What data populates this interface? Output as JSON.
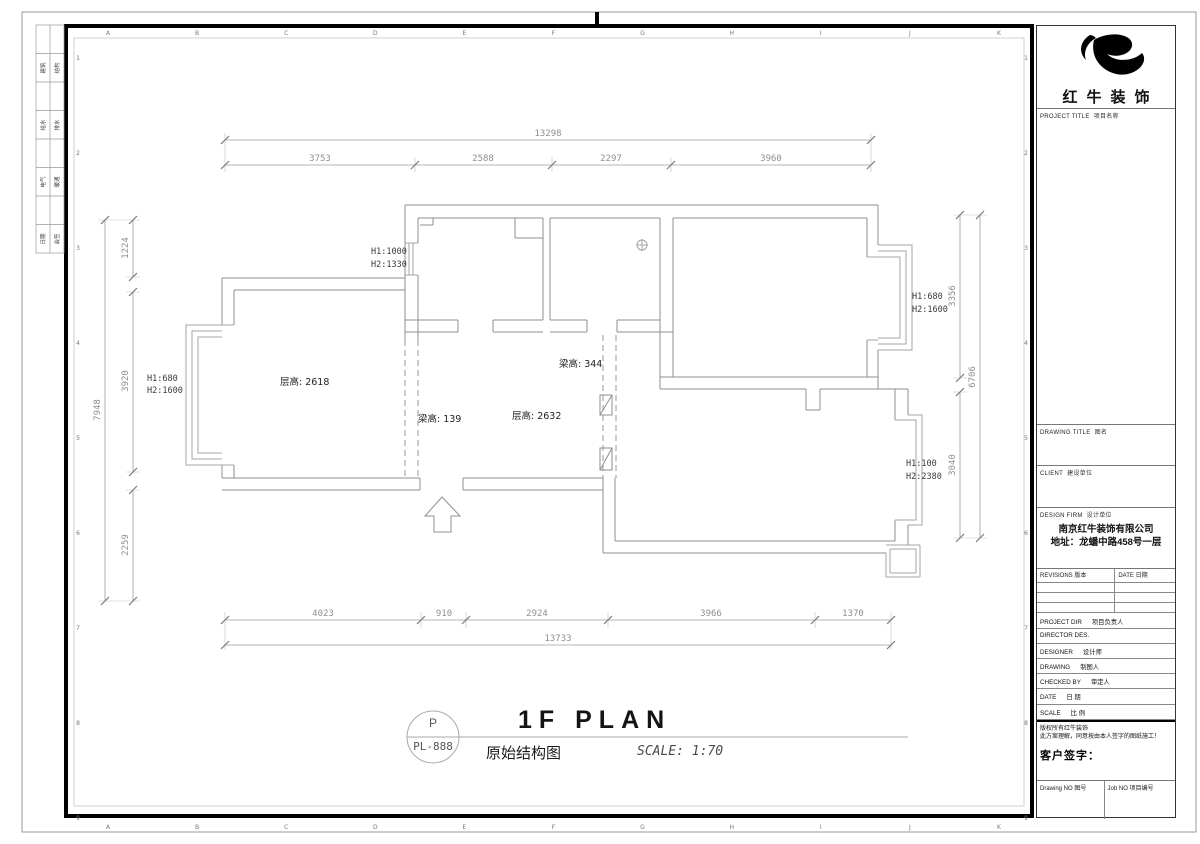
{
  "frame": {
    "top_letters": [
      "A",
      "B",
      "C",
      "D",
      "E",
      "F",
      "G",
      "H",
      "I",
      "J",
      "K"
    ],
    "bottom_letters": [
      "A",
      "B",
      "C",
      "D",
      "E",
      "F",
      "G",
      "H",
      "I",
      "J",
      "K"
    ],
    "left_numbers": [
      "1",
      "2",
      "3",
      "4",
      "5",
      "6",
      "7",
      "8",
      "9"
    ],
    "right_numbers": [
      "1",
      "2",
      "3",
      "4",
      "5",
      "6",
      "7",
      "8",
      "9"
    ]
  },
  "signoff_strip": {
    "rows": [
      [
        "建筑",
        "结构"
      ],
      [
        "给水",
        "排水"
      ],
      [
        "电气",
        "暖通"
      ],
      [
        "日期",
        "会签"
      ]
    ]
  },
  "plan": {
    "dims": {
      "top": {
        "total": "13298",
        "segments": [
          "3753",
          "2588",
          "2297",
          "3960"
        ]
      },
      "bottom": {
        "total": "13733",
        "segments": [
          "4023",
          "910",
          "2924",
          "3966",
          "1370"
        ]
      },
      "left": {
        "total": "7948",
        "segments": [
          "1224",
          "3920",
          "2259"
        ]
      },
      "right": {
        "total": "6706",
        "segments": [
          "3356",
          "3040"
        ]
      }
    },
    "room_labels": {
      "living": "层高: 2618",
      "beam1": "梁高: 139",
      "dining": "层高: 2632",
      "beam2": "梁高: 344"
    },
    "window_labels": {
      "left_bay": {
        "l1": "H1:680",
        "l2": "H2:1600"
      },
      "kitchen": {
        "l1": "H1:1000",
        "l2": "H2:1330"
      },
      "right_bay": {
        "l1": "H1:680",
        "l2": "H2:1600"
      },
      "lower_bay": {
        "l1": "H1:100",
        "l2": "H2:2380"
      }
    }
  },
  "title_bar": {
    "circle_top": "P",
    "circle_code": "PL-888",
    "title_en": "1F PLAN",
    "title_cn": "原始结构图",
    "scale": "SCALE: 1:70"
  },
  "title_block": {
    "brand": "红牛装饰",
    "project_title": {
      "en": "PROJECT TITLE",
      "cn": "项目名称"
    },
    "drawing_title": {
      "en": "DRAWING TITLE",
      "cn": "图名"
    },
    "client": {
      "en": "CLIENT",
      "cn": "建设单位"
    },
    "design_firm": {
      "en": "DESIGN FIRM",
      "cn": "设计单位"
    },
    "firm_name": "南京红牛装饰有限公司",
    "firm_address": "地址：龙蟠中路458号一层",
    "revisions": {
      "en": "REVISIONS 版本",
      "date": "DATE 日期"
    },
    "personnel": [
      {
        "en": "PROJECT DIR",
        "cn": "项目负责人"
      },
      {
        "en": "DIRECTOR DES.",
        "cn": ""
      },
      {
        "en": "DESIGNER",
        "cn": "设计师"
      },
      {
        "en": "DRAWING",
        "cn": "制图人"
      },
      {
        "en": "CHECKED BY",
        "cn": "审定人"
      },
      {
        "en": "DATE",
        "cn": "日 期"
      },
      {
        "en": "SCALE",
        "cn": "比 例"
      }
    ],
    "copyright_line1": "版权所有红牛装饰",
    "copyright_line2": "此方案理解，同意按由本人签字的图纸施工！",
    "client_sign": "客户签字：",
    "drawing_no": "Drawing NO 图号",
    "job_no": "Job NO 项目编号"
  }
}
